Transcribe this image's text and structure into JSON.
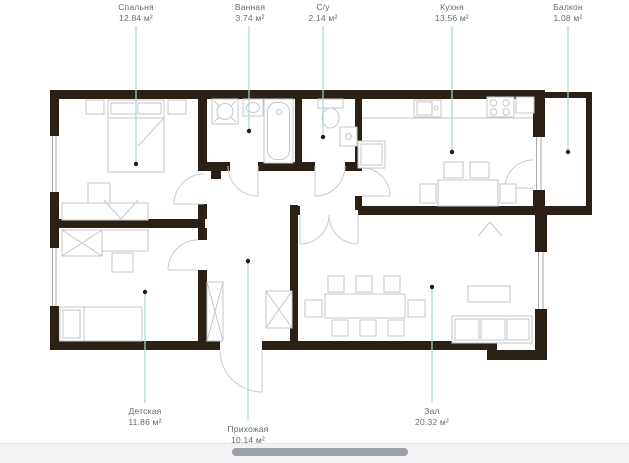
{
  "rooms": [
    {
      "id": "bedroom",
      "name": "Спальня",
      "area": "12.84 м²"
    },
    {
      "id": "bathroom",
      "name": "Ванная",
      "area": "3.74 м²"
    },
    {
      "id": "wc",
      "name": "С/у",
      "area": "2.14 м²"
    },
    {
      "id": "kitchen",
      "name": "Кухня",
      "area": "13.56 м²"
    },
    {
      "id": "balcony",
      "name": "Балкон",
      "area": "1.08 м²"
    },
    {
      "id": "children",
      "name": "Детская",
      "area": "11.86 м²"
    },
    {
      "id": "hallway",
      "name": "Прихожая",
      "area": "10.14 м²"
    },
    {
      "id": "living",
      "name": "Зал",
      "area": "20.32 м²"
    }
  ],
  "colors": {
    "page_bg": "#ffffff",
    "wall_color": "#2b2015",
    "furniture_line": "#c4c7c9",
    "door_line": "#c9ccce",
    "window_line": "#9aa0a4",
    "leader_color": "#a6d7d1",
    "dot_color": "#1c1c1c",
    "label_color": "#636b71",
    "scrollbar_track": "#f2f2f5",
    "scrollbar_thumb": "#9ba1a7"
  }
}
